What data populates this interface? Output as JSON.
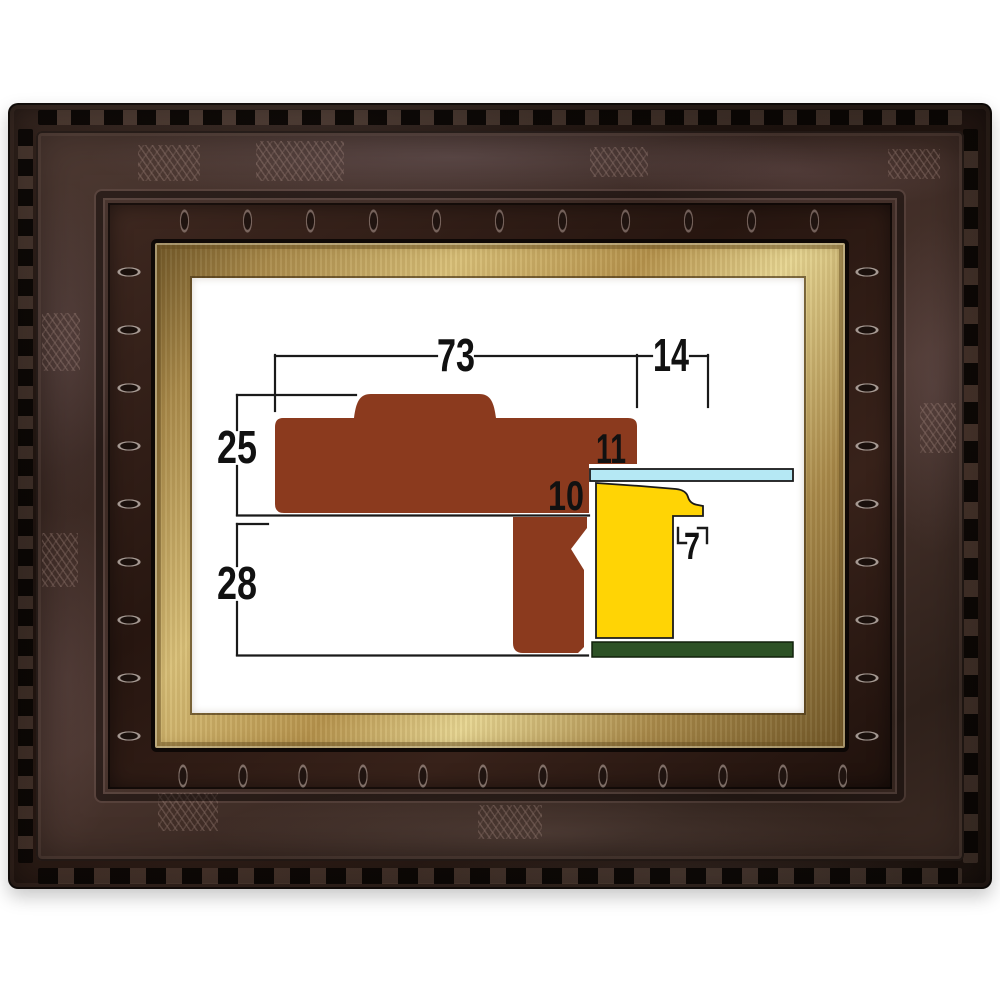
{
  "photo": {
    "background": "#ffffff",
    "subject": "carved dark wood picture frame with gold liner and cross-section diagram"
  },
  "frame": {
    "outer_wood": "#241812",
    "main_band_wood": "#44302a",
    "carving_highlight": "#a99095",
    "liner_gold": "#c9a85e"
  },
  "diagram": {
    "unit": "mm",
    "colors": {
      "moulding": "#8b3a1e",
      "liner": "#ffd405",
      "glass": "#b5e8f4",
      "backboard": "#2d5226",
      "line": "#1a1a1a"
    },
    "dimensions": {
      "overall_width": {
        "label": "73",
        "value": 73
      },
      "liner_visible_width": {
        "label": "14",
        "value": 14
      },
      "upper_height": {
        "label": "25",
        "value": 25
      },
      "lower_height": {
        "label": "28",
        "value": 28
      },
      "lip_height": {
        "label": "11",
        "value": 11
      },
      "rabbet_height": {
        "label": "10",
        "value": 10
      },
      "liner_step_width": {
        "label": "7",
        "value": 7
      }
    }
  }
}
